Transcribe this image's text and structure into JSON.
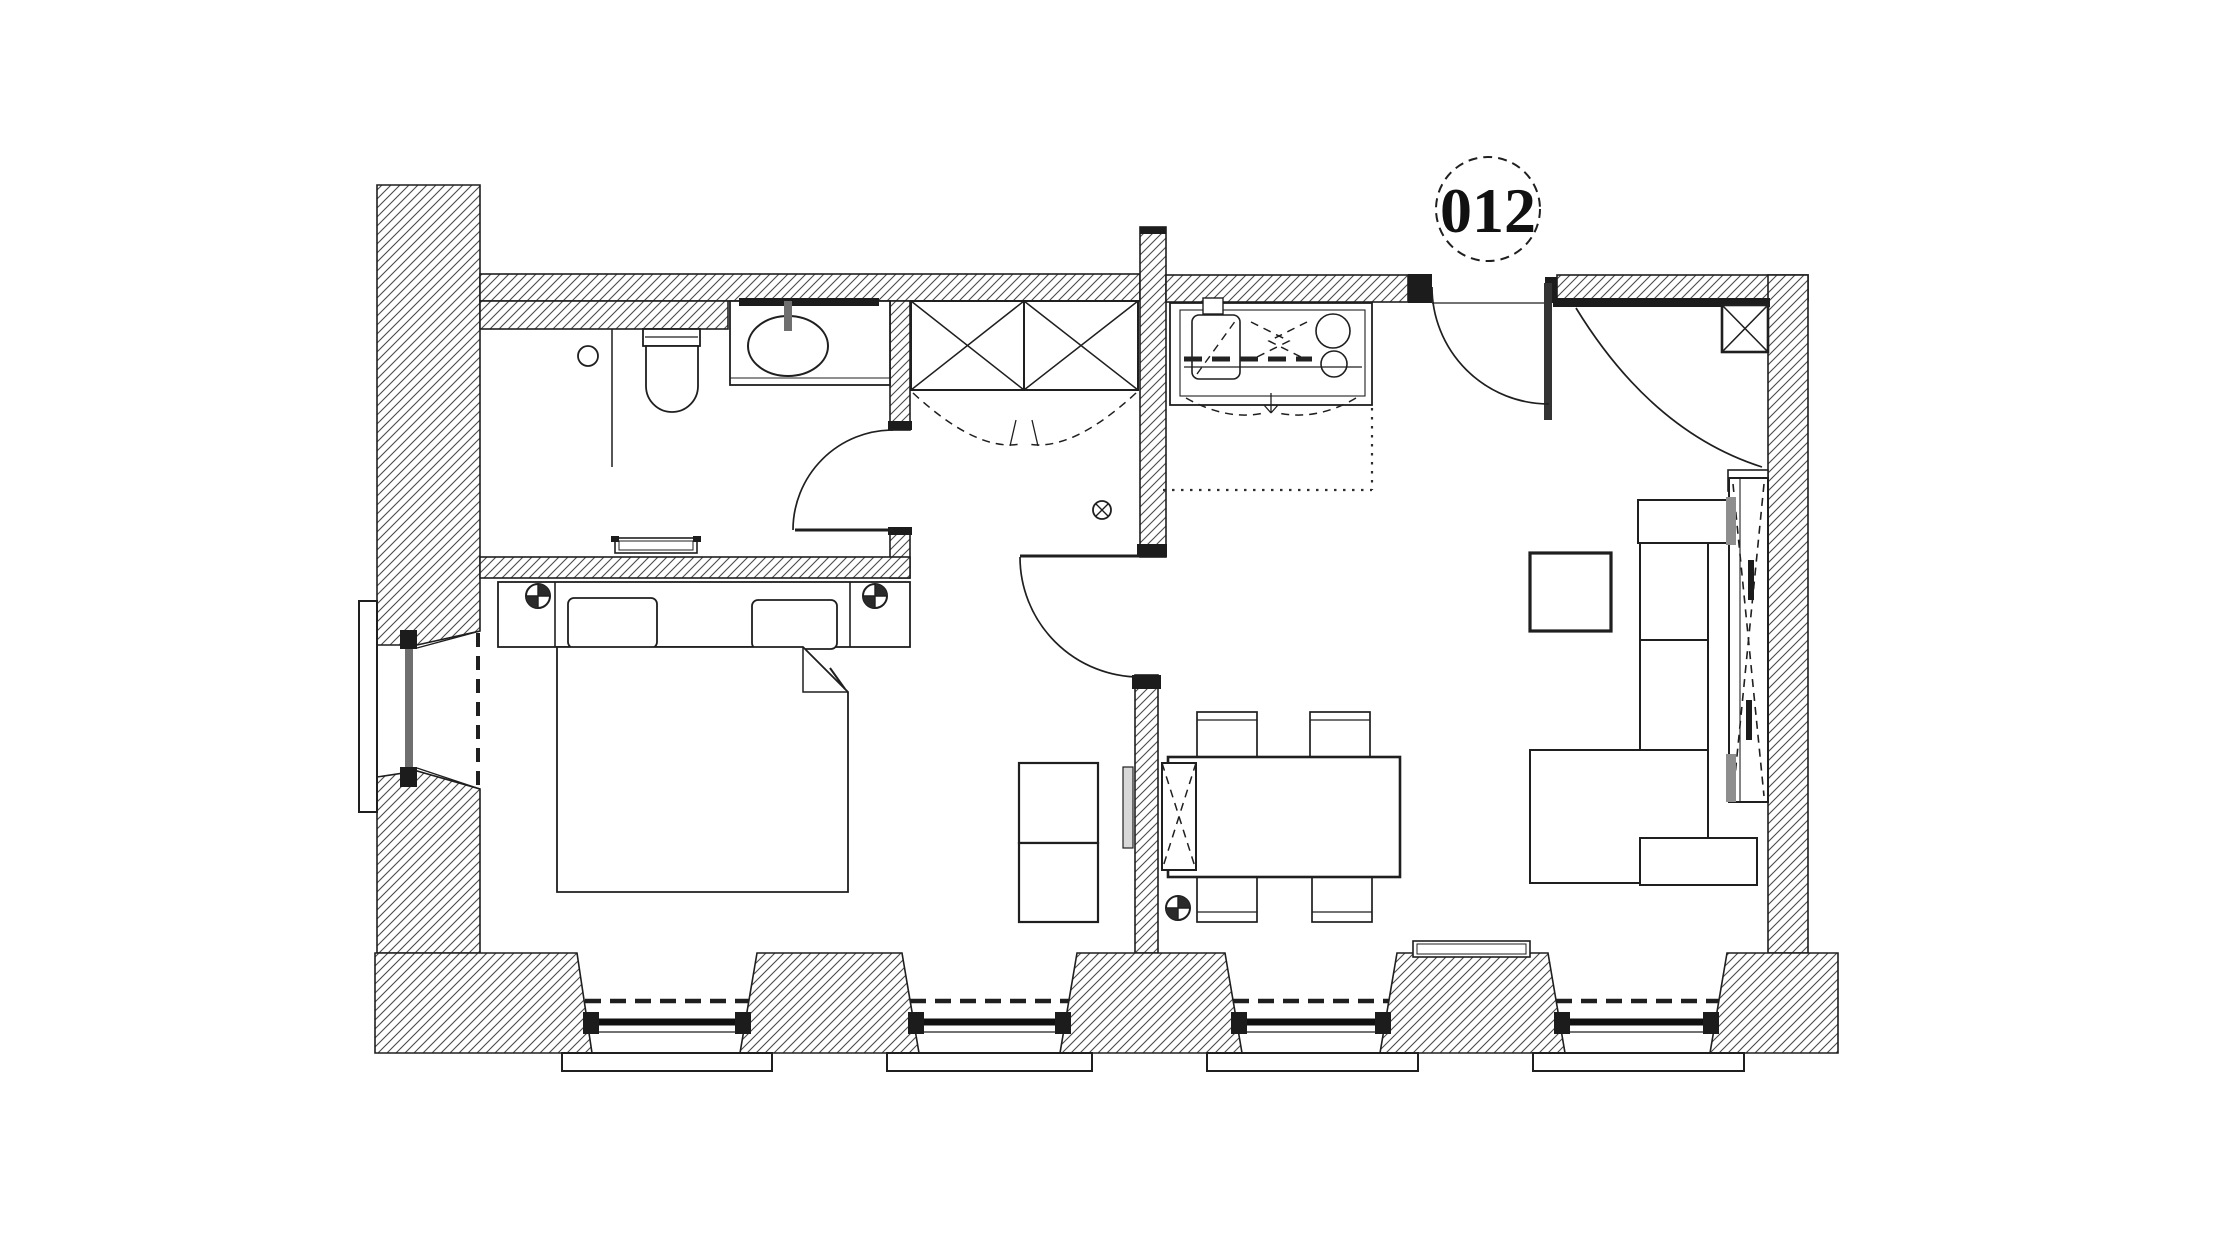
{
  "unit": {
    "label": "012"
  },
  "colors": {
    "paper": "#ffffff",
    "ink": "#1f1f1f",
    "hatch_line": "#4a4a4a",
    "glazing_gray": "#6f6f6f",
    "hinge_gray": "#8e8e8e"
  },
  "symbols": {
    "unit_bubble": "dashed-circle-with-number",
    "survey_marker": "circle-with-filled-quadrants",
    "electrical_outlet": "circle-with-x",
    "shaft": "box-with-x",
    "wardrobe": "double-box-with-x"
  }
}
